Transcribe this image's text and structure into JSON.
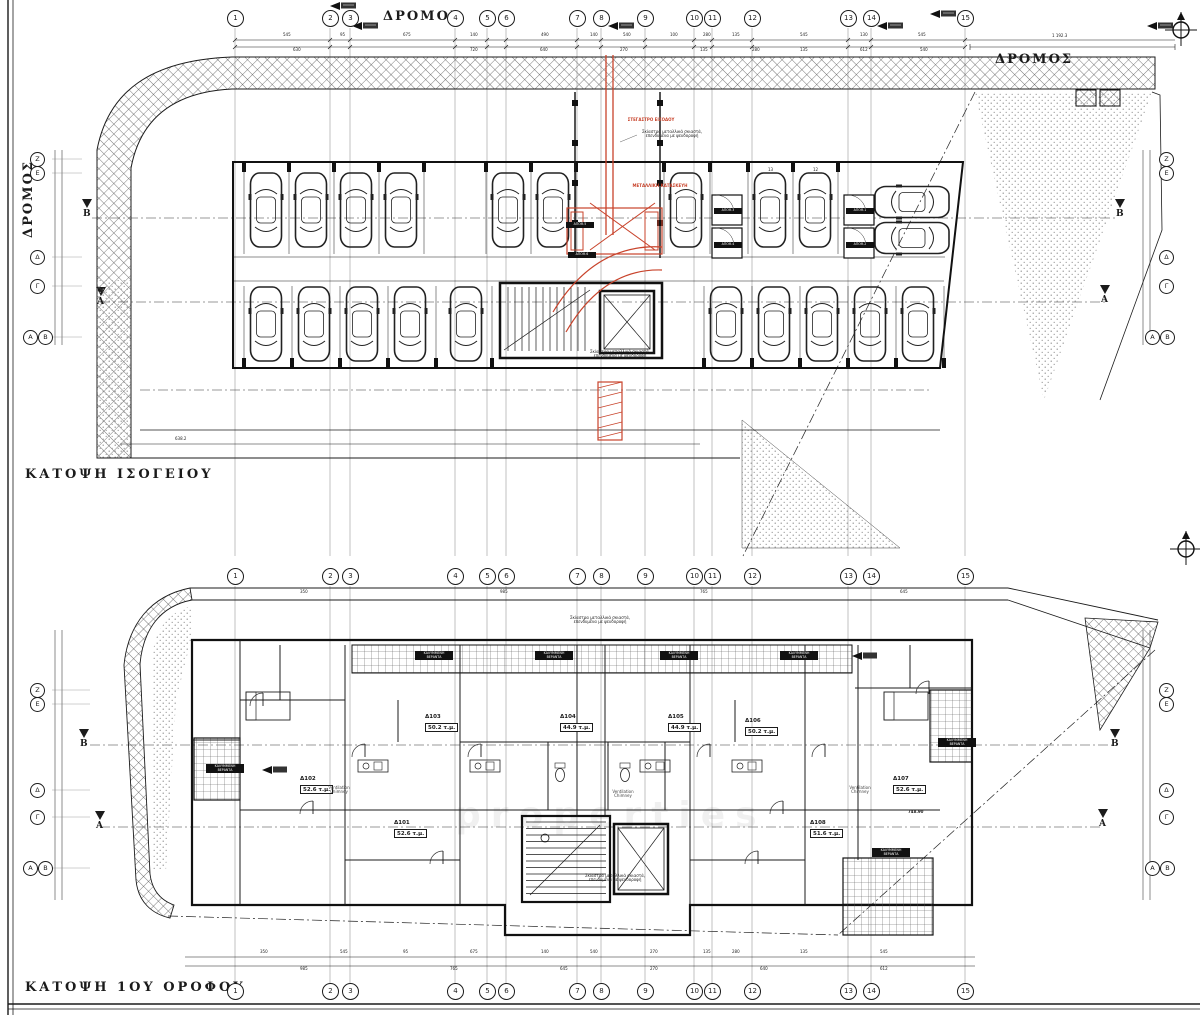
{
  "sheet": {
    "background": "#ffffff",
    "line_color": "#1b1b1b",
    "red_accent": "#c8432b",
    "hatch_color": "#4a4a4a"
  },
  "plans": {
    "ground": {
      "title": "ΚΑΤΟΨΗ ΙΣΟΓΕΙΟΥ"
    },
    "first": {
      "title": "ΚΑΤΟΨΗ 1ΟΥ ΟΡΟΦΟΥ"
    }
  },
  "roads": {
    "top": "ΔΡΟΜΟΣ",
    "top_right": "ΔΡΟΜΟΣ",
    "left": "ΔΡΟΜΟΣ"
  },
  "grid": {
    "columns": [
      "1",
      "2",
      "3",
      "4",
      "5",
      "6",
      "7",
      "8",
      "9",
      "10",
      "11",
      "12",
      "13",
      "14",
      "15"
    ],
    "row_letters": {
      "z": "Ζ",
      "e": "Ε",
      "d": "Δ",
      "g": "Γ",
      "a": "Α",
      "b": "Β"
    }
  },
  "section_markers": {
    "a": "Α",
    "b": "Β"
  },
  "apartments": [
    {
      "id": "Δ101",
      "area": "52.6 τ.μ."
    },
    {
      "id": "Δ102",
      "area": "52.6 τ.μ."
    },
    {
      "id": "Δ103",
      "area": "50.2 τ.μ."
    },
    {
      "id": "Δ104",
      "area": "44.9 τ.μ."
    },
    {
      "id": "Δ105",
      "area": "44.9 τ.μ."
    },
    {
      "id": "Δ106",
      "area": "50.2 τ.μ."
    },
    {
      "id": "Δ107",
      "area": "52.6 τ.μ."
    },
    {
      "id": "Δ108",
      "area": "51.6 τ.μ."
    }
  ],
  "parking": {
    "stall_numbers": [
      "13",
      "12"
    ],
    "storage_labels": [
      "ΑΠΟΘ.1",
      "ΑΠΟΘ.2",
      "ΑΠΟΘ.3",
      "ΑΠΟΘ.4",
      "ΑΠΟΘ.5",
      "ΑΠΟΘ.6"
    ]
  },
  "veranda": {
    "line1": "ΚΑΛΥΜΜΕΝΗ",
    "line2": "ΒΕΡΑΝΤΑ"
  },
  "annotations": {
    "pergola": "Σκίαστρα μεταλλικά σκιαστά, επενδυμένα με ψευδοροφή",
    "ventilation": "Ventilation Chimney",
    "red_note_top": "ΣΤΕΓΑΣΤΡΟ ΕΙΣΟΔΟΥ",
    "red_note_mid": "ΜΕΤΑΛΛΙΚΗ ΚΑΤΑΣΚΕΥΗ",
    "elevation": "748.90"
  },
  "dimensions": {
    "site_width": "1 192.3",
    "plan_width": "638.2",
    "top_row1": [
      "545",
      "95",
      "675",
      "140",
      "490",
      "140",
      "540",
      "100",
      "280",
      "135",
      "545",
      "130",
      "545"
    ],
    "top_row2": [
      "630",
      "720",
      "640",
      "270",
      "135",
      "280",
      "135",
      "612",
      "540"
    ],
    "bottom_row1": [
      "350",
      "545",
      "95",
      "675",
      "140",
      "540",
      "270",
      "135",
      "280",
      "135",
      "545"
    ],
    "bottom_row2": [
      "985",
      "765",
      "645",
      "270",
      "640",
      "612"
    ],
    "road_row": [
      "350",
      "985",
      "765",
      "645"
    ]
  },
  "watermark": "properties"
}
